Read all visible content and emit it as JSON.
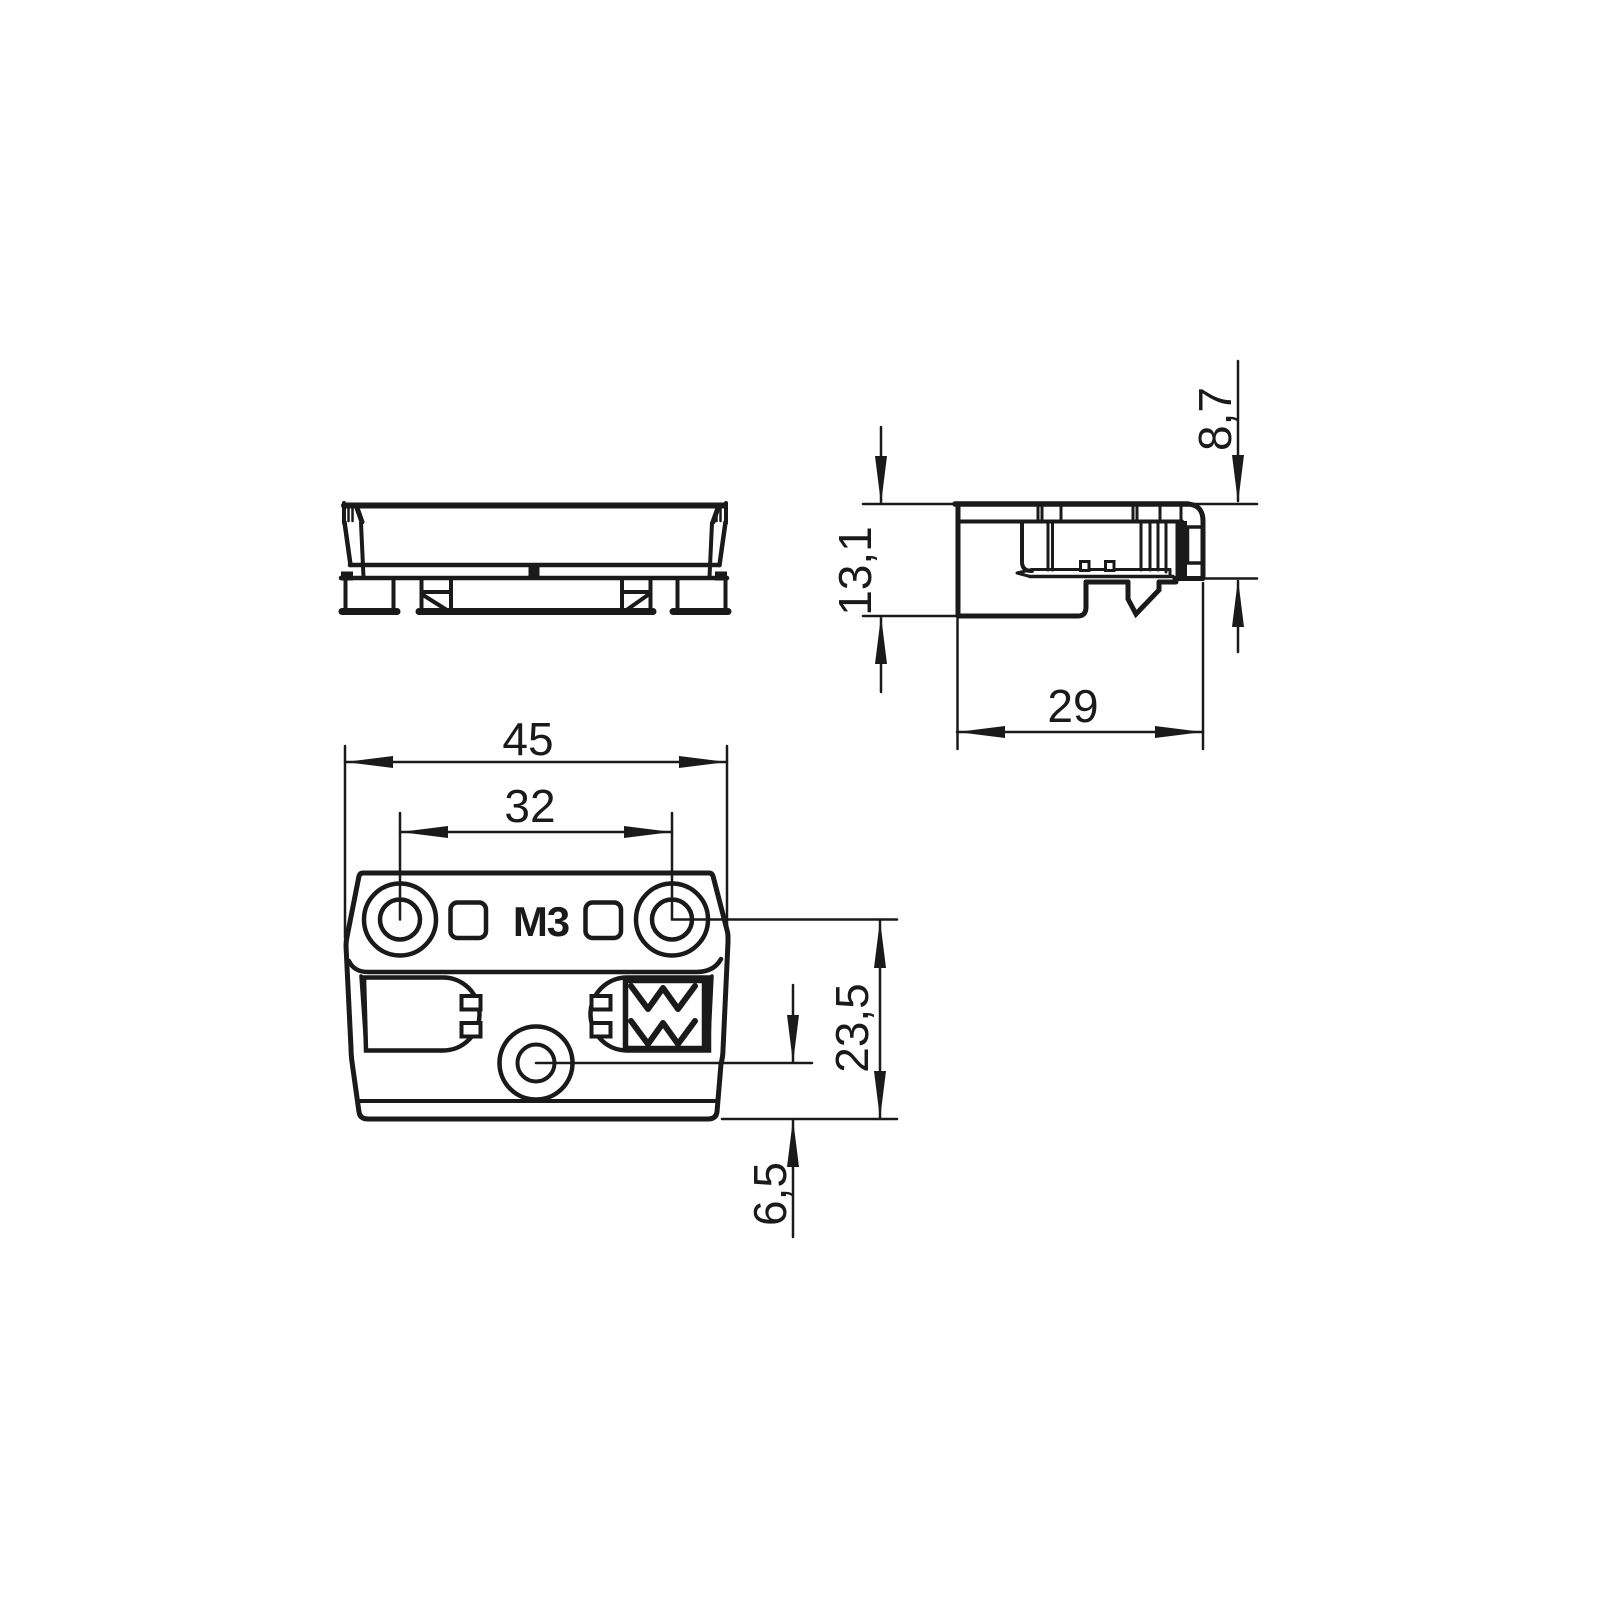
{
  "drawing": {
    "title": "technical dimension drawing - safety switch / sensor housing, three views",
    "colors": {
      "line": "#1a1a1a",
      "background": "#ffffff"
    },
    "labels": {
      "thread": "M3"
    },
    "dimensions": {
      "width_total": "45",
      "hole_spacing": "32",
      "depth": "29",
      "height_total": "13,1",
      "height_body": "8,7",
      "hole_axis_to_bottom": "23,5",
      "center_hole_to_bottom": "6,5"
    }
  }
}
